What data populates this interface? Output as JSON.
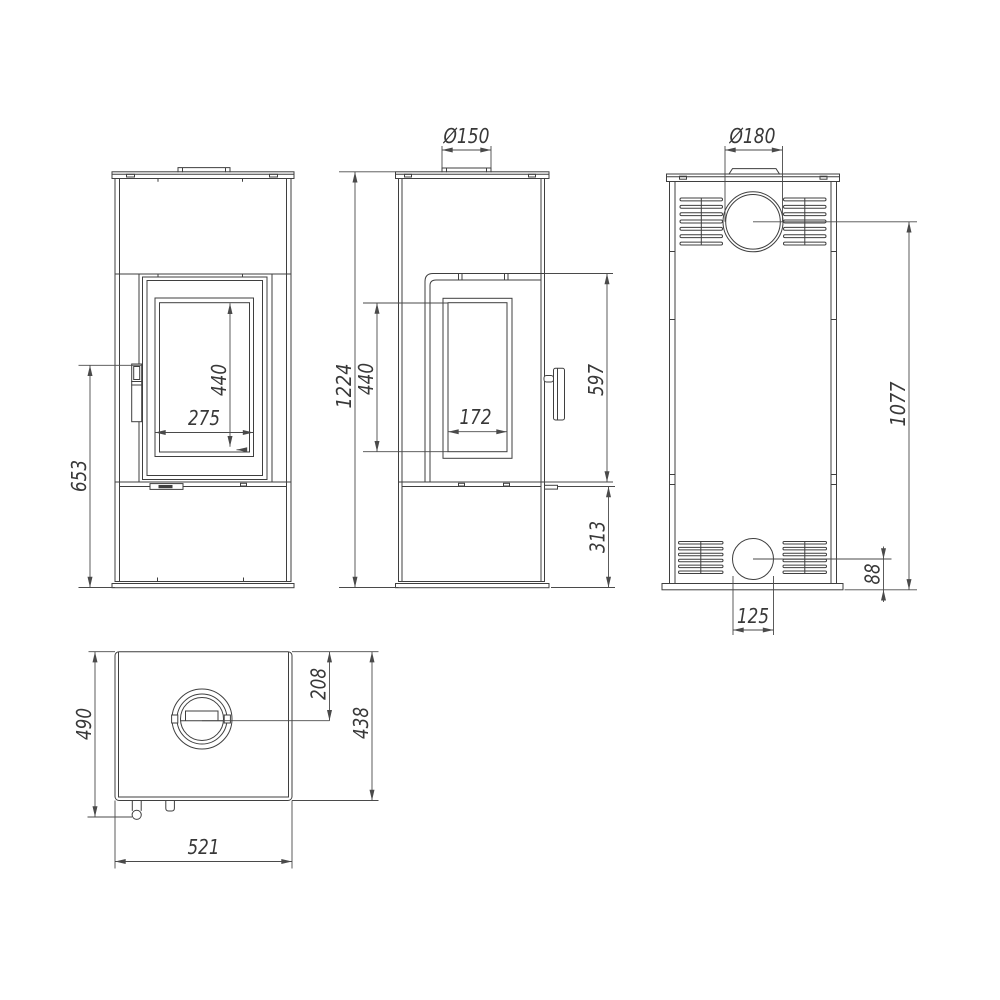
{
  "drawing": {
    "views": {
      "front": {
        "name": "front-view",
        "height_floor_to_handle": "653",
        "glass_height": "440",
        "glass_width": "275"
      },
      "side": {
        "name": "side-view",
        "flue_diameter": "Ø150",
        "total_height": "1224",
        "window_height": "440",
        "window_width": "172",
        "door_height": "597",
        "base_height": "313"
      },
      "back": {
        "name": "back-view",
        "flue_diameter": "Ø180",
        "flue_center_height": "1077",
        "inlet_center_height": "88",
        "inlet_width": "125"
      },
      "top": {
        "name": "top-view",
        "total_depth": "490",
        "flue_center_from_back": "208",
        "body_depth": "438",
        "body_width": "521"
      }
    },
    "colors": {
      "line": "#3f3f3f",
      "dimension_line": "#4a4a4a",
      "background": "#ffffff"
    }
  }
}
